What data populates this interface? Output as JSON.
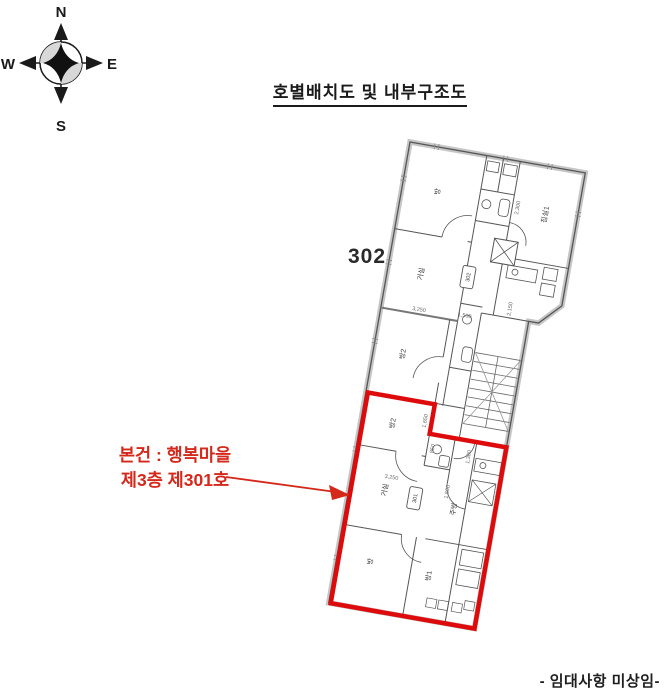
{
  "compass": {
    "n": "N",
    "e": "E",
    "s": "S",
    "w": "W"
  },
  "title": "호별배치도 및 내부구조도",
  "unit302_label": "302",
  "plan": {
    "tags": {
      "upper": "302",
      "lower": "301"
    },
    "rooms": {
      "room_tl": "방",
      "bedroom1": "침실1",
      "living_up": "거실",
      "room2_up": "방2",
      "room2": "방2",
      "living": "거실",
      "kitchen": "주방",
      "room_bl": "방",
      "room1": "방1"
    },
    "dims": {
      "d2300": "2,300",
      "d1500a": "1,500",
      "d2150": "2,150",
      "d3250a": "3,250",
      "d1650": "1,650",
      "d850": "850",
      "d3250b": "3,250",
      "d1500b": "1,500",
      "d1300": "1,300"
    }
  },
  "subject_note": {
    "line1": "본건 : 행복마을",
    "line2": "제3층 제301호"
  },
  "footer_note": "- 임대사항 미상임-",
  "colors": {
    "highlight": "#dd0b0b",
    "note_red": "#d4281a",
    "ink": "#555555"
  }
}
